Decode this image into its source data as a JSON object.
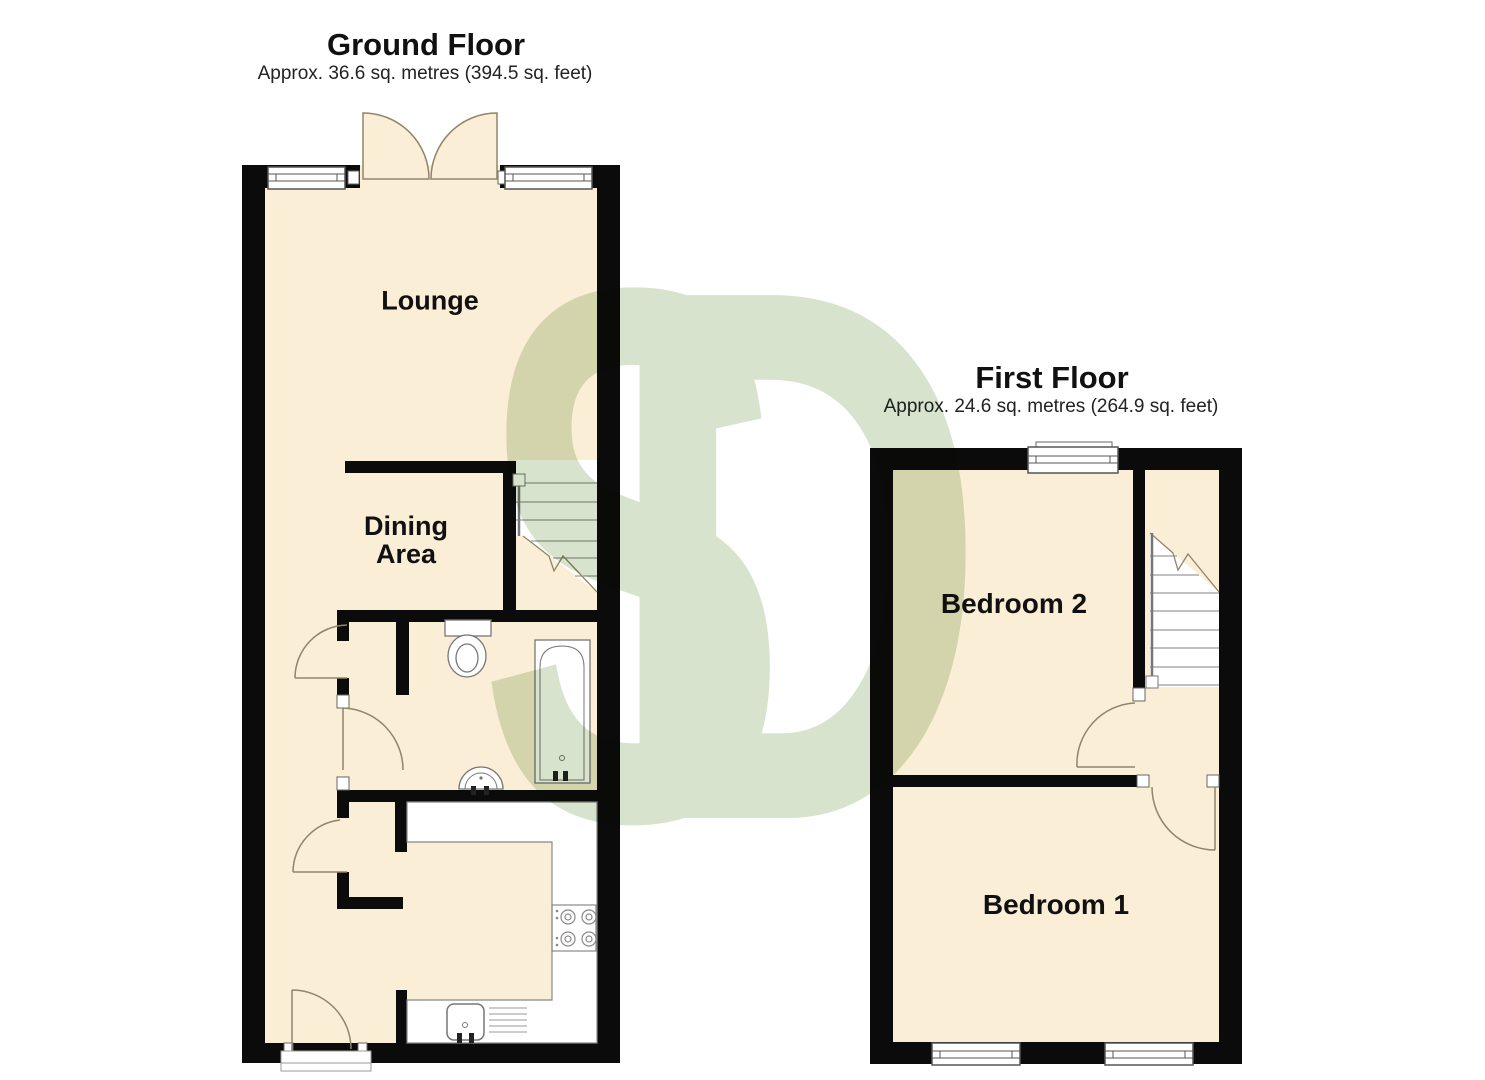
{
  "ground_floor": {
    "title": "Ground Floor",
    "subtitle": "Approx. 36.6 sq. metres (394.5 sq. feet)",
    "rooms": {
      "lounge": "Lounge",
      "dining_line1": "Dining",
      "dining_line2": "Area"
    }
  },
  "first_floor": {
    "title": "First Floor",
    "subtitle": "Approx. 24.6 sq. metres (264.9 sq. feet)",
    "rooms": {
      "bedroom2": "Bedroom 2",
      "bedroom1": "Bedroom 1"
    }
  },
  "watermark": {
    "letter_s": "S",
    "letter_d": "D",
    "color": "#d7e3cc"
  },
  "colors": {
    "wall": "#0b0b0b",
    "floor": "#fbeed6",
    "fixture_outline": "#777777",
    "door_swing": "#8f8568",
    "step_line": "#9a9a9a"
  }
}
